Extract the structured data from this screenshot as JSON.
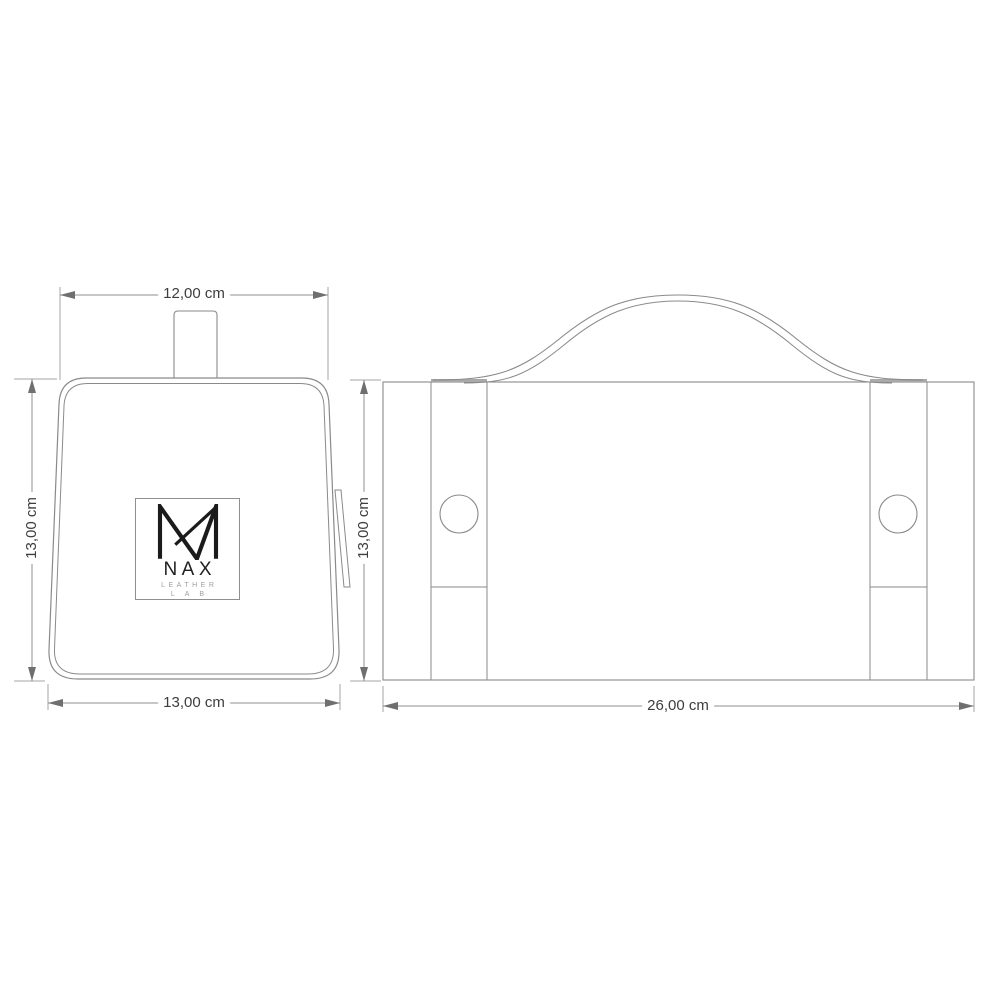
{
  "page": {
    "background_color": "#ffffff"
  },
  "drawing": {
    "side_view": {
      "dim_top_width": "12,00 cm",
      "dim_height": "13,00 cm",
      "dim_bottom_width": "13,00 cm",
      "logo": {
        "brand": "NAX",
        "subtitle": "LEATHER",
        "subtitle2": "LAB"
      }
    },
    "front_view": {
      "dim_height": "13,00 cm",
      "dim_width": "26,00 cm"
    },
    "colors": {
      "outline": "#8a8a8a",
      "dimension_line": "#8f8f8f",
      "extension_line": "#a6a6a6",
      "arrow_fill": "#6f6f6f",
      "dimension_text": "#3d3d3d",
      "logo_black": "#1b1b1b",
      "logo_gray": "#9e9e9e"
    }
  }
}
